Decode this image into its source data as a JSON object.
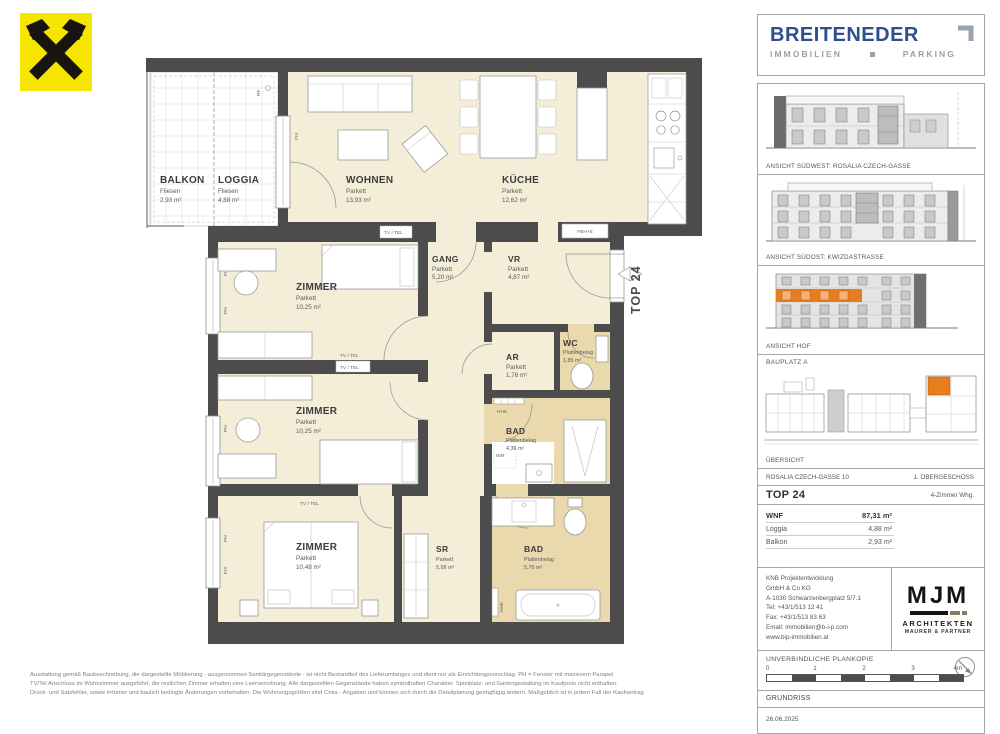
{
  "branding": {
    "raiffeisen_alt": "raiffeisen-gable-cross-logo",
    "brand": "BREITENEDER",
    "brand_sub_left": "IMMOBILIEN",
    "brand_sub_right": "PARKING"
  },
  "floorplan": {
    "unit_label": "TOP 24",
    "rooms": [
      {
        "name": "BALKON",
        "floor": "Fliesen",
        "area": "2,93 m²"
      },
      {
        "name": "LOGGIA",
        "floor": "Fliesen",
        "area": "4,88 m²"
      },
      {
        "name": "WOHNEN",
        "floor": "Parkett",
        "area": "13,93 m²"
      },
      {
        "name": "KÜCHE",
        "floor": "Parkett",
        "area": "12,62 m²"
      },
      {
        "name": "GANG",
        "floor": "Parkett",
        "area": "5,20 m²"
      },
      {
        "name": "VR",
        "floor": "Parkett",
        "area": "4,87 m²"
      },
      {
        "name": "ZIMMER",
        "floor": "Parkett",
        "area": "10,25 m²"
      },
      {
        "name": "AR",
        "floor": "Parkett",
        "area": "1,76 m²"
      },
      {
        "name": "WC",
        "floor": "Plattenbelag",
        "area": "1,85 m²"
      },
      {
        "name": "BAD",
        "floor": "Plattenbelag",
        "area": "4,36 m²"
      },
      {
        "name": "ZIMMER",
        "floor": "Parkett",
        "area": "10,25 m²"
      },
      {
        "name": "ZIMMER",
        "floor": "Parkett",
        "area": "10,48 m²"
      },
      {
        "name": "SR",
        "floor": "Parkett",
        "area": "5,98 m²"
      },
      {
        "name": "BAD",
        "floor": "Plattenbelag",
        "area": "5,76 m²"
      }
    ],
    "annotations": {
      "tv_tel": "TV / TEL",
      "fix": "FIX",
      "ph": "PH",
      "hhk": "HHK",
      "wm": "WM",
      "fbh_e": "FBH+E",
      "rf": "RF"
    }
  },
  "sidebar": {
    "captions": {
      "sw": "ANSICHT SÜDWEST: ROSALIA CZECH-GASSE",
      "so": "ANSICHT SÜDOST: KWIZDASTRASSE",
      "hof": "ANSICHT HOF",
      "bauplatz": "BAUPLATZ  A",
      "uebersicht": "ÜBERSICHT"
    },
    "info": {
      "address": "ROSALIA CZECH-GASSE 10",
      "floor": "1. OBERGESCHOSS",
      "top": "TOP 24",
      "type": "4-Zimmer Whg.",
      "wnf_label": "WNF",
      "wnf": "87,31 m²",
      "loggia_label": "Loggia",
      "loggia": "4,88 m²",
      "balkon_label": "Balkon",
      "balkon": "2,93 m²"
    },
    "contact": {
      "line1": "KNB Projektentwicklung",
      "line2": "GmbH & Co KG",
      "line3": "A-1030 Schwarzenbergplatz 5/7.1",
      "line4": "Tel: +43/1/513 12 41",
      "line5": "Fax: +43/1/513 83 63",
      "line6": "Email: immobilien@b-i-p.com",
      "line7": "www.bip-immobilien.at"
    },
    "architects": {
      "logo": "MJM",
      "line1": "ARCHITEKTEN",
      "line2": "MAURER & PARTNER"
    },
    "plan": {
      "plankopie": "UNVERBINDLICHE PLANKOPIE",
      "scale_0": "0",
      "scale_1": "1",
      "scale_2": "2",
      "scale_3": "3",
      "scale_4": "4m",
      "type": "GRUNDRISS",
      "date": "26.06.2025"
    }
  },
  "footer": {
    "disclaimer_1": "Ausstattung gemäß Baubeschreibung, die dargestellte Möblierung - ausgenommen Sanitärgegenstände - ist nicht Bestandteil des Lieferumfanges und dient nur als Einrichtungsvorschlag. PH = Fenster mit massivem Parapet",
    "disclaimer_2": "TV/Tel Anschluss im Wohnzimmer ausgeführt, die restlichen Zimmer erhalten eine Leerverrohrung. Alle dargestellten Gegenstände haben symbolhaften Charakter. Spielplatz- und Gartengestaltung im Kaufpreis nicht enthalten.",
    "disclaimer_3": "Druck- und Satzfehler, sowie Irrtümer und baulich bedingte Änderungen vorbehalten. Die Wohnungsgrößen sind Cirka - Angaben und können sich durch die Detailplanung geringfügig ändern. Maßgeblich ist in jedem Fall der Kaufvertrag."
  },
  "colors": {
    "accent_orange": "#e87d1e",
    "brand_blue": "#2e4f8c",
    "wall_gray": "#4c4c4c",
    "parkett_cream": "#f4eed8",
    "tile_tan": "#e9d9ac",
    "logo_yellow": "#f6e500"
  }
}
